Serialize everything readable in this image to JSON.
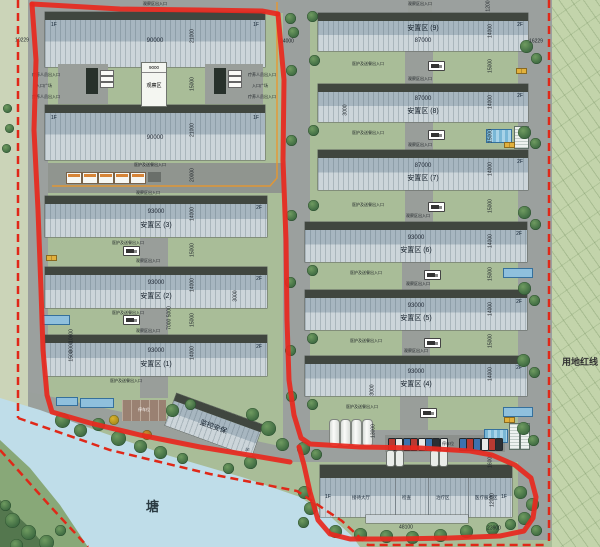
{
  "plan": {
    "pond_label": "塘",
    "red_line_label": "用地红线",
    "colors": {
      "boundary": "#e8281e",
      "red_dashed": "#e02818",
      "water": "#bfdde9",
      "route_orange": "#e8962e"
    }
  },
  "left_big_buildings": {
    "top": {
      "floor_left": "1F",
      "floor_right": "1F",
      "length": "90000"
    },
    "bottom": {
      "floor_left": "1F",
      "floor_right": "1F",
      "length": "90000"
    }
  },
  "observation": {
    "width": "9000",
    "label": "观察区"
  },
  "side_labels": {
    "staff_entry": "疗养人员出入口",
    "plaza": "入口广场"
  },
  "resettlement_left": [
    {
      "name": "安置区 (3)",
      "length": "93000",
      "floor": "2F"
    },
    {
      "name": "安置区 (2)",
      "length": "93000",
      "floor": "2F"
    },
    {
      "name": "安置区 (1)",
      "length": "93000",
      "floor": "2F"
    }
  ],
  "resettlement_right": [
    {
      "name": "安置区 (9)",
      "length": "87000",
      "floor": "2F"
    },
    {
      "name": "安置区 (8)",
      "length": "87000",
      "floor": "2F"
    },
    {
      "name": "安置区 (7)",
      "length": "87000",
      "floor": "2F"
    },
    {
      "name": "安置区 (6)",
      "length": "93000",
      "floor": "2F"
    },
    {
      "name": "安置区 (5)",
      "length": "93000",
      "floor": "2F"
    },
    {
      "name": "安置区 (4)",
      "length": "93000",
      "floor": "2F"
    }
  ],
  "medical_building": {
    "floor_left": "1F",
    "floor_right": "1F",
    "rooms": [
      "接待大厅",
      "检查",
      "治疗区",
      "医疗服务区"
    ]
  },
  "security_building": {
    "name": "监控安保",
    "floor": "1F"
  },
  "annotations": {
    "entry_top": "观察区出入口",
    "entry_bottom": "医护及送餐出入口",
    "parking": "停车位"
  },
  "dims": {
    "d90000": "90000",
    "d87000": "87000",
    "d93000": "93000",
    "d21000": "21000",
    "d14000": "14000",
    "d15000": "15000",
    "d20000": "20000",
    "d24000": "24000",
    "d16229": "16229",
    "d10229": "10229",
    "d1200": "1200",
    "d9000": "9000",
    "d3000": "3000",
    "d7000_5000": "7000 5000",
    "d10600": "10600",
    "d1500": "1500",
    "d13000": "13000",
    "d16000": "16000",
    "d12000": "12000",
    "d48100": "48100",
    "d23900": "23900"
  }
}
